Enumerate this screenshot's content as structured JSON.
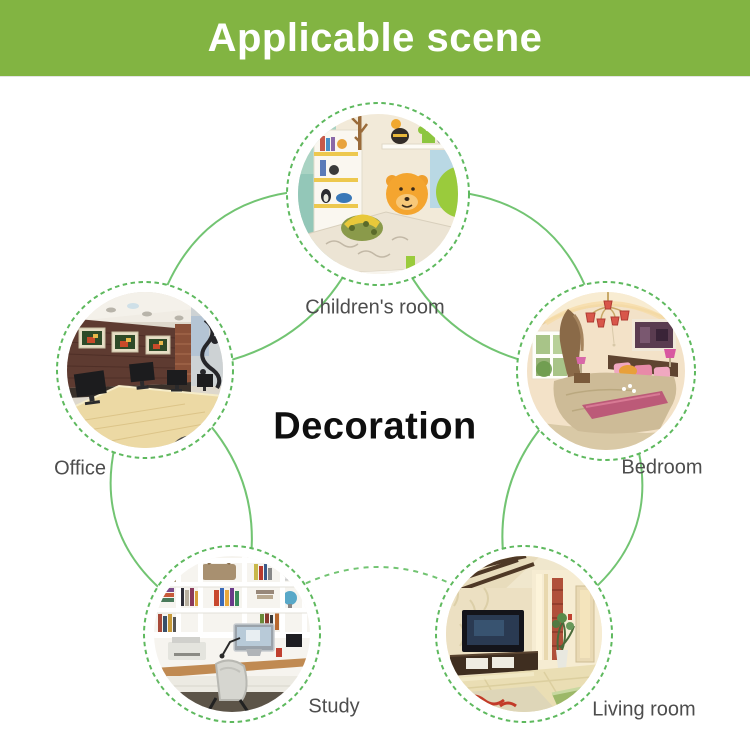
{
  "header": {
    "title": "Applicable scene",
    "bg_color": "#82b442",
    "text_color": "#ffffff"
  },
  "center_label": "Decoration",
  "diagram": {
    "line_color": "#72c472",
    "ring_color": "#5eb95e",
    "label_color": "#4d4d4d",
    "scenes": [
      {
        "label": "Children's room"
      },
      {
        "label": "Office"
      },
      {
        "label": "Bedroom"
      },
      {
        "label": "Study"
      },
      {
        "label": "Living room"
      }
    ]
  }
}
